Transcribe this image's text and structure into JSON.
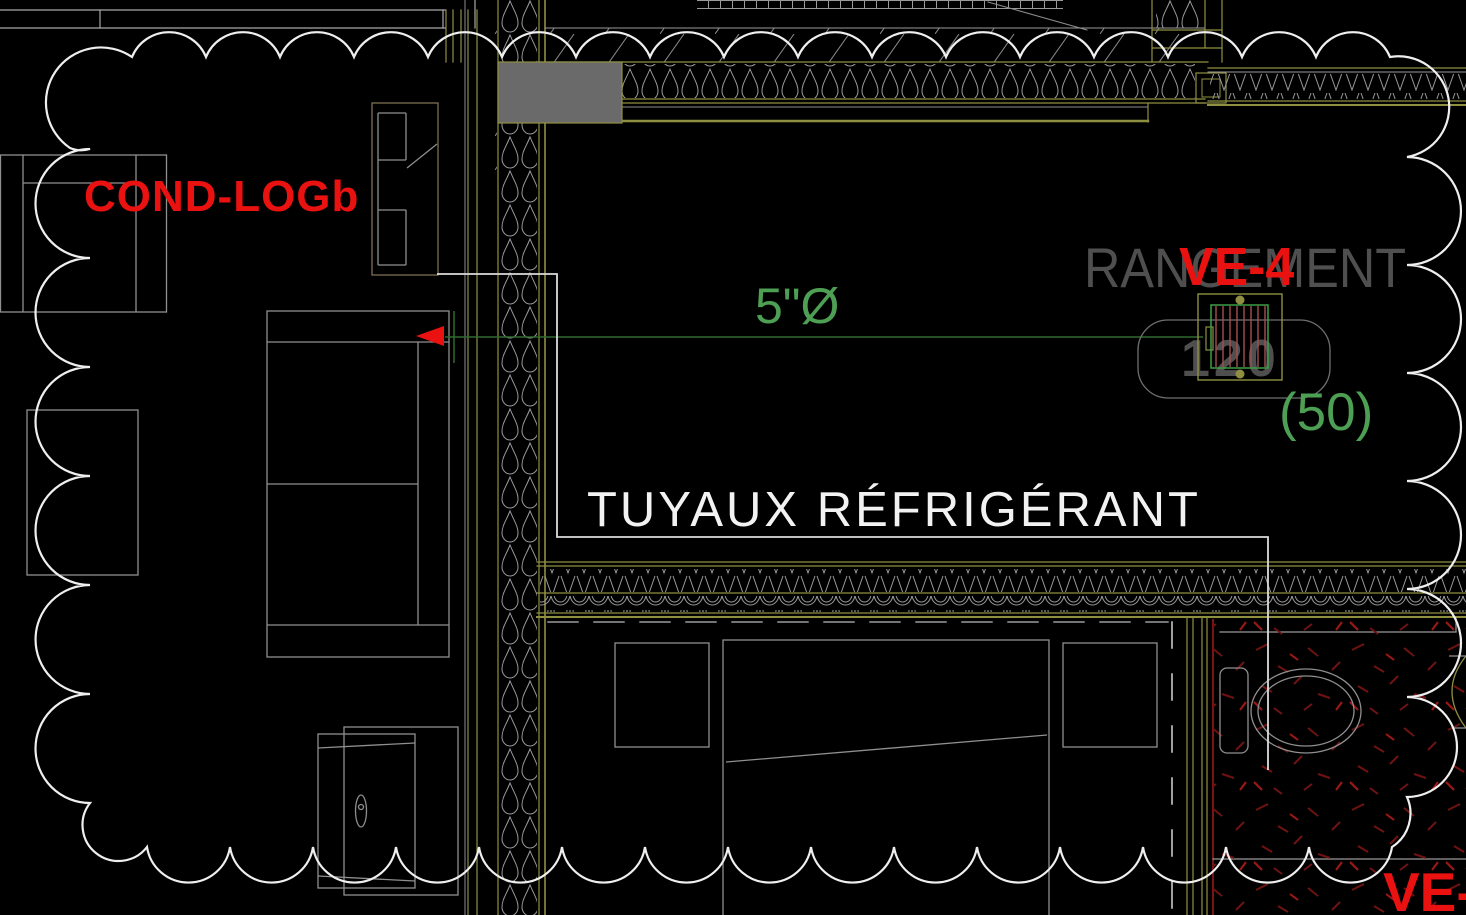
{
  "drawing": {
    "labels": {
      "condenser_tag": "COND-LOGb",
      "room_name": "RANGEMENT",
      "diffuser_tag": "VE-4",
      "diffuser_size": "120",
      "diffuser_flow": "(50)",
      "pipe_diameter": "5\"Ø",
      "pipe_label": "TUYAUX RÉFRIGÉRANT",
      "corner_tag_partial": "VE-"
    },
    "colors": {
      "background": "#000000",
      "annotation_red": "#ea1111",
      "annotation_green": "#4d9f53",
      "pipe_line_green": "#2f6b2f",
      "cad_olive": "#8f8f42",
      "muted_gray_text": "#4f4f4f",
      "linework_gray": "#9a9a9a",
      "revision_cloud_white": "#efefef",
      "tile_hatch_red": "#6e1212"
    }
  }
}
